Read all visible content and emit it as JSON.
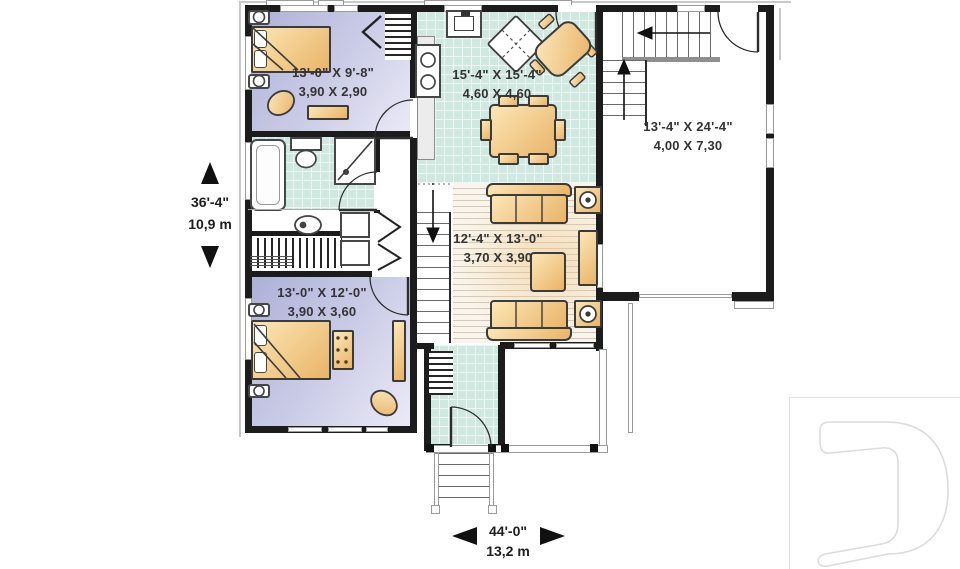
{
  "rooms": [
    {
      "id": "bedroom-1",
      "imperial": "13'-0\" X 9'-8\"",
      "metric": "3,90 X 2,90"
    },
    {
      "id": "kitchen-dining",
      "imperial": "15'-4\" X 15'-4\"",
      "metric": "4,60 X 4,60"
    },
    {
      "id": "garage",
      "imperial": "13'-4\" X 24'-4\"",
      "metric": "4,00 X 7,30"
    },
    {
      "id": "living-room",
      "imperial": "12'-4\" X 13'-0\"",
      "metric": "3,70 X 3,90"
    },
    {
      "id": "bedroom-2",
      "imperial": "13'-0\" X 12'-0\"",
      "metric": "3,90 X 3,60"
    }
  ],
  "overall_dimensions": {
    "depth_imperial": "36'-4\"",
    "depth_metric": "10,9 m",
    "width_imperial": "44'-0\"",
    "width_metric": "13,2 m"
  },
  "logo": {
    "letter": "D"
  },
  "colors": {
    "wall": "#1c1c1c",
    "bedroom_floor": "#c6c8e4",
    "tile_floor": "#cfe9e1",
    "wood_floor": "#f9f5ec",
    "furniture": "#f0cb90",
    "logo_outline": "#dcdcdc"
  }
}
